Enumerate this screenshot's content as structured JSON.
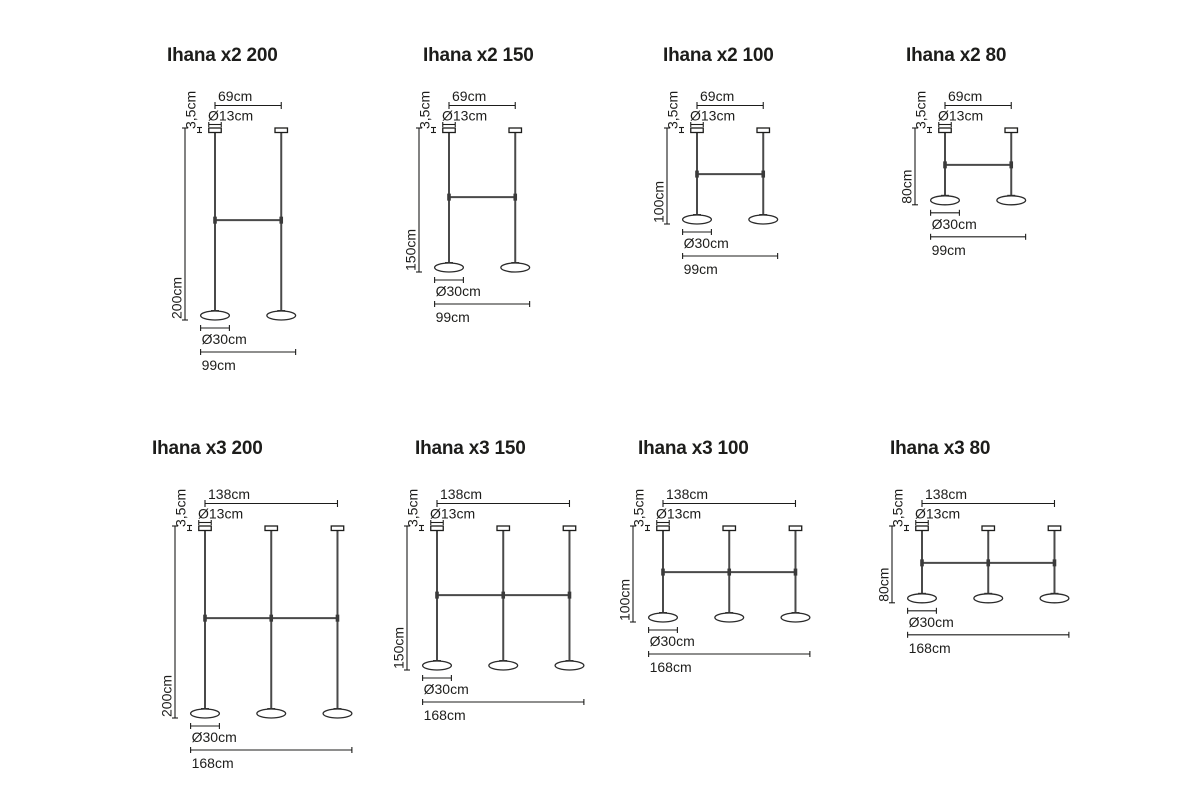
{
  "page": {
    "background": "#ffffff",
    "ink": "#1d1d1b",
    "metal": "#4a4a4a"
  },
  "product": "Ihana",
  "diagrams": [
    {
      "title": "Ihana x2 200",
      "lamps": 2,
      "dims": {
        "top_width": "69cm",
        "canopy_diameter": "Ø13cm",
        "canopy_height": "3,5cm",
        "drop_height": "200cm",
        "shade_diameter": "Ø30cm",
        "overall_width": "99cm"
      },
      "values_cm": {
        "top_width": 69,
        "canopy_diameter": 13,
        "canopy_height": 3.5,
        "drop_height": 200,
        "shade_diameter": 30,
        "overall_width": 99
      }
    },
    {
      "title": "Ihana x2 150",
      "lamps": 2,
      "dims": {
        "top_width": "69cm",
        "canopy_diameter": "Ø13cm",
        "canopy_height": "3,5cm",
        "drop_height": "150cm",
        "shade_diameter": "Ø30cm",
        "overall_width": "99cm"
      },
      "values_cm": {
        "top_width": 69,
        "canopy_diameter": 13,
        "canopy_height": 3.5,
        "drop_height": 150,
        "shade_diameter": 30,
        "overall_width": 99
      }
    },
    {
      "title": "Ihana x2 100",
      "lamps": 2,
      "dims": {
        "top_width": "69cm",
        "canopy_diameter": "Ø13cm",
        "canopy_height": "3,5cm",
        "drop_height": "100cm",
        "shade_diameter": "Ø30cm",
        "overall_width": "99cm"
      },
      "values_cm": {
        "top_width": 69,
        "canopy_diameter": 13,
        "canopy_height": 3.5,
        "drop_height": 100,
        "shade_diameter": 30,
        "overall_width": 99
      }
    },
    {
      "title": "Ihana x2 80",
      "lamps": 2,
      "dims": {
        "top_width": "69cm",
        "canopy_diameter": "Ø13cm",
        "canopy_height": "3,5cm",
        "drop_height": "80cm",
        "shade_diameter": "Ø30cm",
        "overall_width": "99cm"
      },
      "values_cm": {
        "top_width": 69,
        "canopy_diameter": 13,
        "canopy_height": 3.5,
        "drop_height": 80,
        "shade_diameter": 30,
        "overall_width": 99
      }
    },
    {
      "title": "Ihana x3 200",
      "lamps": 3,
      "dims": {
        "top_width": "138cm",
        "canopy_diameter": "Ø13cm",
        "canopy_height": "3,5cm",
        "drop_height": "200cm",
        "shade_diameter": "Ø30cm",
        "overall_width": "168cm"
      },
      "values_cm": {
        "top_width": 138,
        "canopy_diameter": 13,
        "canopy_height": 3.5,
        "drop_height": 200,
        "shade_diameter": 30,
        "overall_width": 168
      }
    },
    {
      "title": "Ihana x3 150",
      "lamps": 3,
      "dims": {
        "top_width": "138cm",
        "canopy_diameter": "Ø13cm",
        "canopy_height": "3,5cm",
        "drop_height": "150cm",
        "shade_diameter": "Ø30cm",
        "overall_width": "168cm"
      },
      "values_cm": {
        "top_width": 138,
        "canopy_diameter": 13,
        "canopy_height": 3.5,
        "drop_height": 150,
        "shade_diameter": 30,
        "overall_width": 168
      }
    },
    {
      "title": "Ihana x3 100",
      "lamps": 3,
      "dims": {
        "top_width": "138cm",
        "canopy_diameter": "Ø13cm",
        "canopy_height": "3,5cm",
        "drop_height": "100cm",
        "shade_diameter": "Ø30cm",
        "overall_width": "168cm"
      },
      "values_cm": {
        "top_width": 138,
        "canopy_diameter": 13,
        "canopy_height": 3.5,
        "drop_height": 100,
        "shade_diameter": 30,
        "overall_width": 168
      }
    },
    {
      "title": "Ihana x3 80",
      "lamps": 3,
      "dims": {
        "top_width": "138cm",
        "canopy_diameter": "Ø13cm",
        "canopy_height": "3,5cm",
        "drop_height": "80cm",
        "shade_diameter": "Ø30cm",
        "overall_width": "168cm"
      },
      "values_cm": {
        "top_width": 138,
        "canopy_diameter": 13,
        "canopy_height": 3.5,
        "drop_height": 80,
        "shade_diameter": 30,
        "overall_width": 168
      }
    }
  ]
}
